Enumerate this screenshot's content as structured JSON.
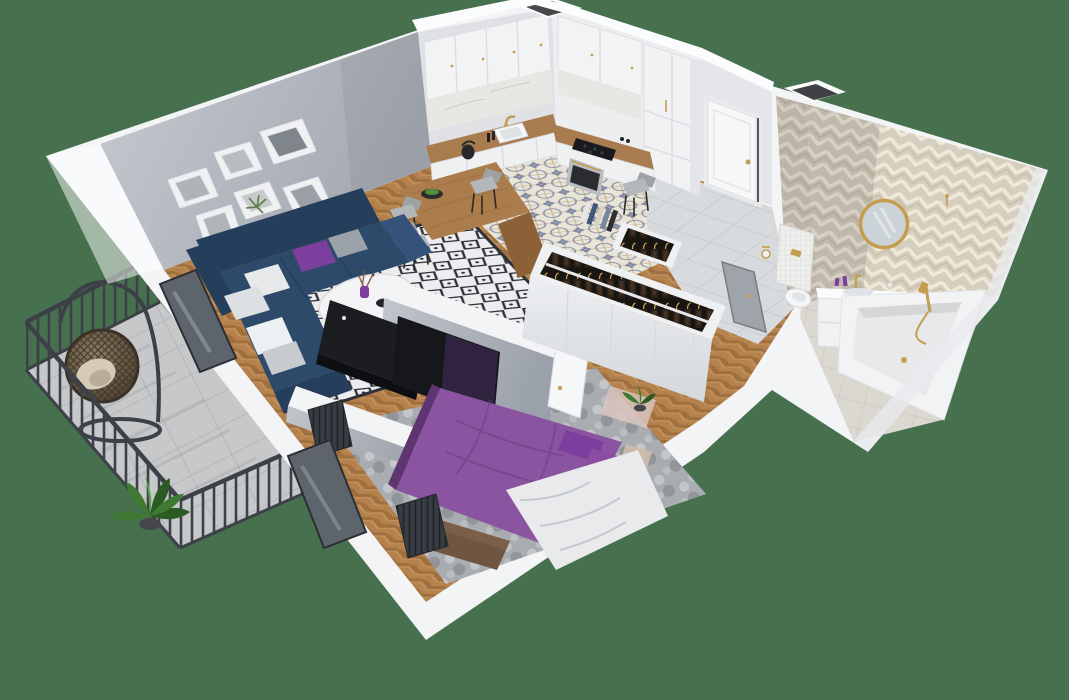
{
  "scene": {
    "title": "3D isometric floor plan render of a one-bedroom apartment",
    "view": "photorealistic dimetric top-down cutaway, walls cut at mid height",
    "background": "solid muted green"
  },
  "palette": {
    "background": "#47704f",
    "wall_white": "#f3f4f6",
    "wall_gray": "#b6bac2",
    "wood_floor": "#b5824d",
    "kitchen_tile": "#e8e4d8",
    "tile_ornament": "#8b94ab",
    "entry_tile": "#d8dbdd",
    "bathroom_tile": "#dbd8d1",
    "chevron_tile": "#d6cfbf",
    "rug_white": "#ededef",
    "rug_lattice": "#2e3237",
    "bedroom_rug_grey": "#a9adb1",
    "sofa_navy": "#2e4a6b",
    "sofa_navy_dark": "#243e5b",
    "cushion_purple": "#7d3f9e",
    "bed_purple": "#8b54a0",
    "blanket_white": "#e9eaec",
    "tv_black": "#16171b",
    "console_black": "#1c1d21",
    "wood_table": "#ab7c4c",
    "counter_wood": "#a87c4e",
    "gold": "#c59d4f",
    "railing": "#3c4148",
    "concrete": "#c6c8ca",
    "rattan": "#6b5b45",
    "chair_grey": "#b5b8ba",
    "plant_green": "#3e7a33",
    "plant_green_dark": "#2c5a24",
    "clothes_dark": "#2b2118",
    "door_white": "#f6f7f9",
    "glass_dark": "#5d646c",
    "headboard_beige": "#cbb9ac",
    "bench_brown": "#6f5542",
    "mirror_glass": "#ccd3d8"
  },
  "rooms": {
    "living_room": {
      "label": "Living room",
      "items": [
        "navy corner sofa with purple, grey and white cushions",
        "round white coffee table with purple vase and black bowls",
        "black media console",
        "TV on stepped room divider",
        "black and white diamond pattern rug",
        "gallery wall of seven framed prints",
        "radiator below balcony window",
        "herringbone oak floor"
      ]
    },
    "kitchen_dining": {
      "label": "Kitchen and dining area",
      "items": [
        "white shaker cabinets with brass handles",
        "timber worktop with white sink and brass tap",
        "black hob with built-in oven",
        "tall fridge cabinet column",
        "ventilation shaft",
        "wooden breakfast table with grey chairs",
        "bowl of fruit",
        "kettle",
        "patterned encaustic tile floor"
      ]
    },
    "hallway": {
      "label": "Entry hallway",
      "items": [
        "white entrance door with brass handle",
        "open coat rack with hanging clothes",
        "large grey floor tiles",
        "glass bathroom door"
      ]
    },
    "wardrobe": {
      "label": "Wardrobe wall",
      "items": [
        "open-top white wardrobe full of hanging clothes",
        "books stacked on top"
      ]
    },
    "bedroom": {
      "label": "Bedroom",
      "items": [
        "double bed with purple duvet",
        "white crumpled throw",
        "beige headboard",
        "purple pillows",
        "wooden end-of-bed bench",
        "grey mottled rug",
        "TV facing the bed",
        "radiator below balcony window",
        "small potted plant",
        "herringbone oak floor"
      ]
    },
    "bathroom": {
      "label": "Bathroom",
      "items": [
        "chevron tiled walls",
        "round brass framed mirror",
        "white vanity with brass tap and purple accessories",
        "toilet with mosaic tiled cistern and brass flush plate",
        "brass toilet roll holder",
        "built-in bathtub with brass hand shower",
        "ventilation shaft"
      ]
    },
    "balcony": {
      "label": "Balcony",
      "items": [
        "black metal bar railing",
        "concrete tile floor",
        "hanging rattan egg chair with beige cushion",
        "potted green plant"
      ]
    }
  }
}
